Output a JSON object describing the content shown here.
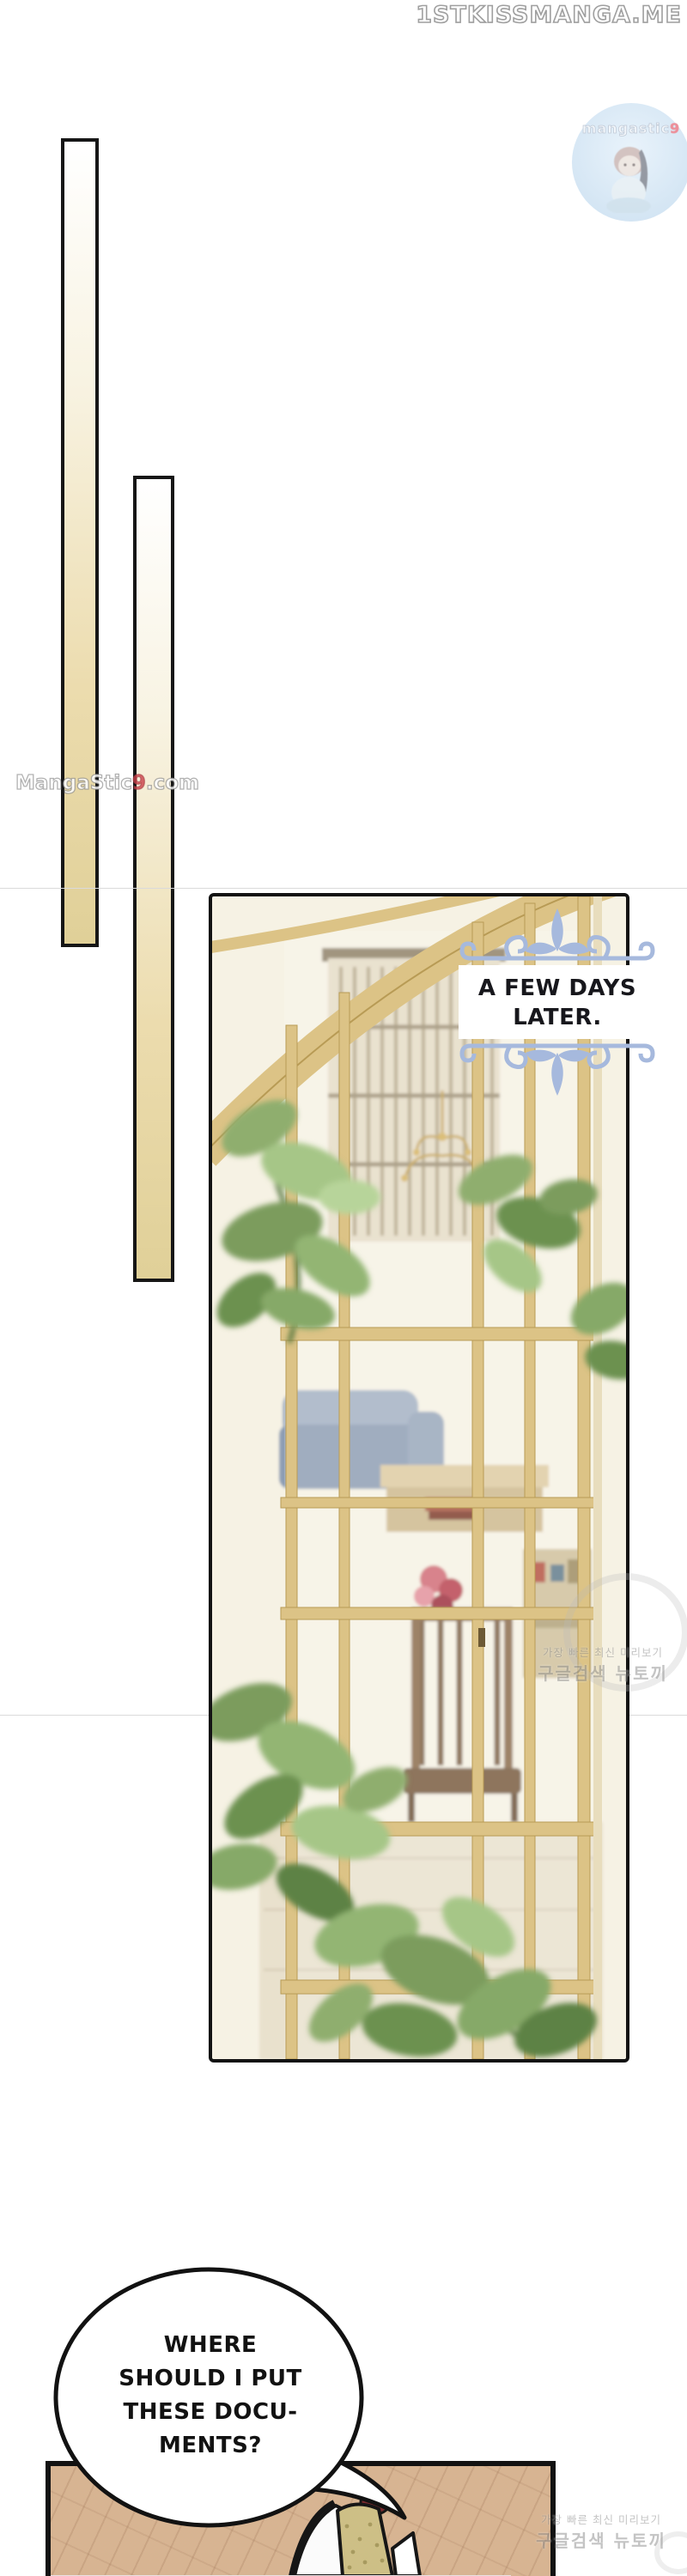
{
  "site": {
    "title": "1STKISSMANGA.ME"
  },
  "badge": {
    "label_main": "mangastic",
    "label_digit": "9",
    "bg_color": "#d5e6f4",
    "digit_color": "#ee8b97"
  },
  "side_watermark": {
    "main": "MangaStic",
    "digit": "9",
    "suffix": ".com"
  },
  "caption": {
    "line1": "A FEW DAYS",
    "line2": "LATER.",
    "flourish_color": "#a6b9dd"
  },
  "korean_watermark": {
    "line_small": "가장 빠른 최신 미리보기",
    "line_large": "구글검색 뉴토끼"
  },
  "speech": {
    "line1": "WHERE",
    "line2": "SHOULD I PUT",
    "line3": "THESE DOCU-",
    "line4": "MENTS?"
  },
  "palette": {
    "bar_tan": "#e0d098",
    "window_frame_tan": "#dcc386",
    "leaf_green": "#86a968",
    "floor_tan": "#d7b492",
    "flower_red": "#c0505c",
    "panel_border": "#121212"
  }
}
